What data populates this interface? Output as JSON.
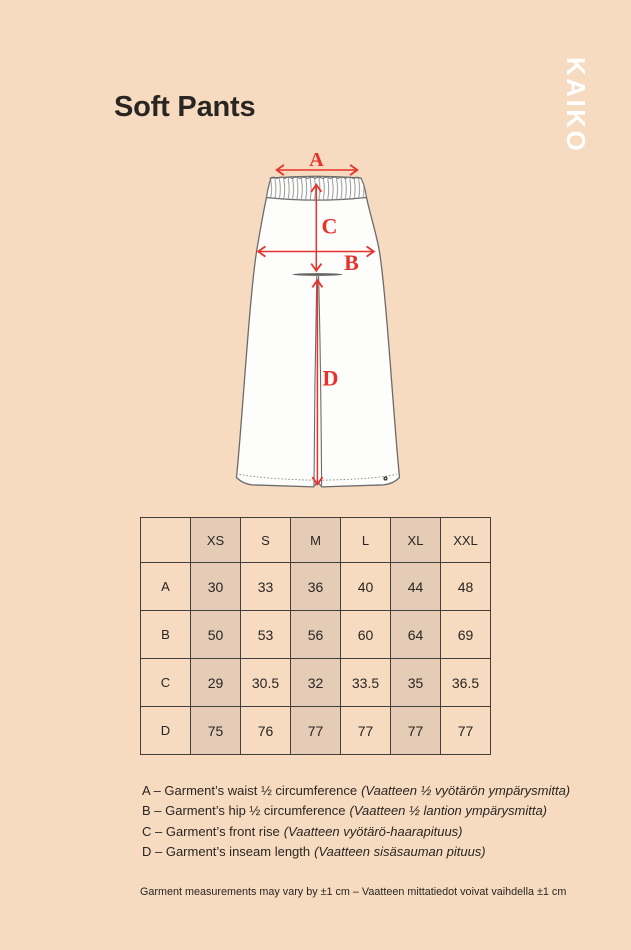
{
  "colors": {
    "background": "#f6dbc0",
    "accent": "#e5322b",
    "ink": "#2a2522",
    "border": "#433e39",
    "shade": "#e4ccb6",
    "line": "#6b6b6b",
    "brand": "#ffffff",
    "garment": "#fdfdfc"
  },
  "header": {
    "title": "Soft Pants",
    "brand": "KAIKO"
  },
  "diagram": {
    "subject": "pants-technical-sketch",
    "arrow_labels": {
      "a": "A",
      "b": "B",
      "c": "C",
      "d": "D"
    }
  },
  "table": {
    "headers": [
      "XS",
      "S",
      "M",
      "L",
      "XL",
      "XXL"
    ],
    "rows": [
      {
        "label": "A",
        "values": [
          "30",
          "33",
          "36",
          "40",
          "44",
          "48"
        ]
      },
      {
        "label": "B",
        "values": [
          "50",
          "53",
          "56",
          "60",
          "64",
          "69"
        ]
      },
      {
        "label": "C",
        "values": [
          "29",
          "30.5",
          "32",
          "33.5",
          "35",
          "36.5"
        ]
      },
      {
        "label": "D",
        "values": [
          "75",
          "76",
          "77",
          "77",
          "77",
          "77"
        ]
      }
    ]
  },
  "chart_data": {
    "type": "table",
    "columns": [
      "",
      "XS",
      "S",
      "M",
      "L",
      "XL",
      "XXL"
    ],
    "rows": [
      [
        "A",
        30,
        33,
        36,
        40,
        44,
        48
      ],
      [
        "B",
        50,
        53,
        56,
        60,
        64,
        69
      ],
      [
        "C",
        29,
        30.5,
        32,
        33.5,
        35,
        36.5
      ],
      [
        "D",
        75,
        76,
        77,
        77,
        77,
        77
      ]
    ]
  },
  "legend": {
    "items": [
      {
        "en": "A – Garment’s waist ½ circumference",
        "fi": "(Vaatteen ½ vyötärön ympärysmitta)"
      },
      {
        "en": "B – Garment’s hip ½ circumference",
        "fi": "(Vaatteen ½ lantion ympärysmitta)"
      },
      {
        "en": "C – Garment’s front rise",
        "fi": "(Vaatteen vyötärö-haarapituus)"
      },
      {
        "en": "D – Garment’s inseam length",
        "fi": "(Vaatteen sisäsauman pituus)"
      }
    ]
  },
  "footer": {
    "note": "Garment measurements may vary by ±1 cm – Vaatteen mittatiedot voivat vaihdella ±1 cm"
  }
}
